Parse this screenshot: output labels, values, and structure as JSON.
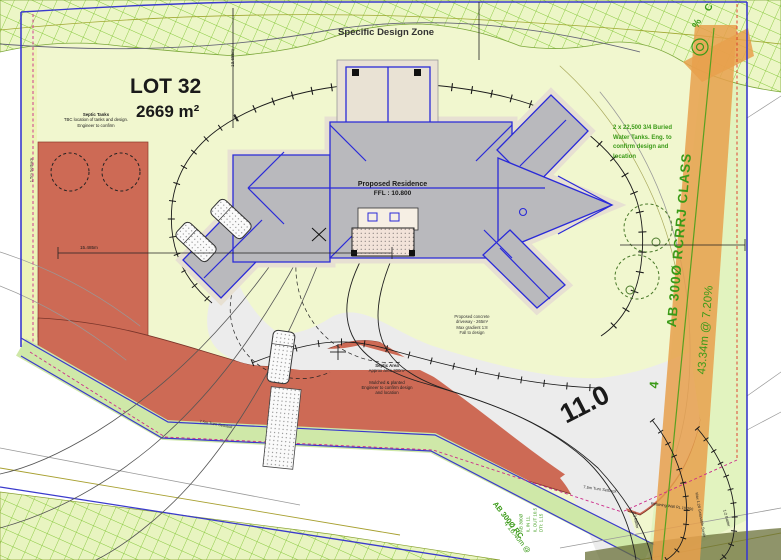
{
  "zones": {
    "specific_design_zone_label": "Specific Design Zone"
  },
  "lot": {
    "number": "LOT 32",
    "area": "2669 m²"
  },
  "residence": {
    "label": "Proposed Residence",
    "ffl": "FFL : 10.800"
  },
  "notes": {
    "septic_tanks": {
      "title": "Septic Tanks",
      "line1": "TBC location of tanks and design.",
      "line2": "Engineer to confirm"
    },
    "water_tanks": {
      "line1": "2 x 22,500 3/4 Buried",
      "line2": "Water Tanks. Eng. to",
      "line3": "confirm design and",
      "line4": "location"
    },
    "septic_area": {
      "title": "Septic Area",
      "line1": "Approx area 300m²",
      "line2": "Mulched & planted",
      "line3": "Engineer to confirm design",
      "line4": "and location"
    },
    "driveway": {
      "line1": "Proposed concrete",
      "line2": "driveway - 265m²",
      "line3": "Max gradient 1:8",
      "line4": "Fall to design"
    }
  },
  "pipes": {
    "main": {
      "label": "AB 300Ø RCRRJ CLASS",
      "class_num": "4",
      "grade": "43.34m @ 7.20%"
    },
    "secondary": {
      "label": "AB 300Ø RC",
      "grade": "4 16.40m @"
    },
    "partial_top": {
      "line1": "C",
      "line2": "%"
    },
    "pit_data": {
      "line1": "AB 300Ø",
      "line2": "IL IN 11.",
      "line3": "IL OUT 10.5",
      "line4": "DTI: 1.15"
    }
  },
  "dimensions": {
    "left_width": "15.485m",
    "top_height": "13.685m",
    "contour": "11.0"
  },
  "small_labels": {
    "setback_left": "1.5m Setback",
    "turn_setback_a": "7.5m Turn Setback",
    "turn_setback_b": "7.5m Turn Setback",
    "batter_left": "1:2 Batter",
    "batter_right": "1:2 Batter",
    "swale": "Max 1:20 Grassable Swale",
    "retaining": "Retaining Wall RL 10.250"
  },
  "colors": {
    "boundary_blue": "#3a3acc",
    "setback_magenta": "#cc2a8a",
    "setback_red": "#dd3322",
    "septic_red": "#cd6a55",
    "pipe_orange": "#e8a04c",
    "hatch_green": "#86c83c",
    "text_green": "#3a9a17",
    "roof_blue": "#2a2ad8",
    "lot_fill": "#f1f7cf"
  }
}
